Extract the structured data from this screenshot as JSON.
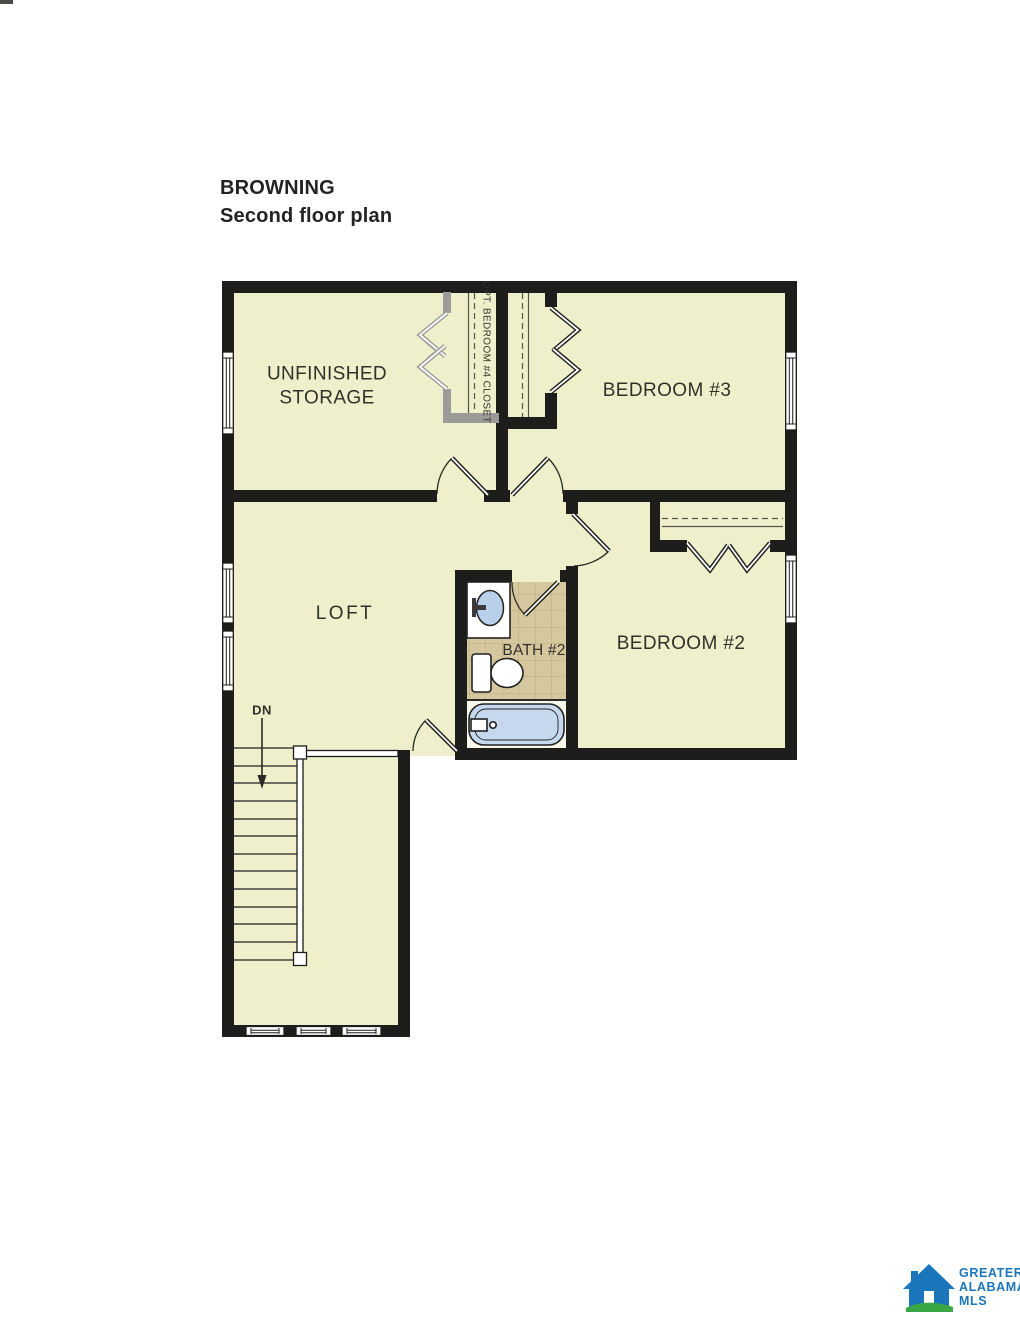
{
  "page": {
    "title_line1": "BROWNING",
    "title_line2": "Second floor plan"
  },
  "plan": {
    "rooms": [
      {
        "id": "unfinished-storage",
        "label": "UNFINISHED STORAGE"
      },
      {
        "id": "bedroom-3",
        "label": "BEDROOM #3"
      },
      {
        "id": "loft",
        "label": "LOFT"
      },
      {
        "id": "bath-2",
        "label": "BATH #2"
      },
      {
        "id": "bedroom-2",
        "label": "BEDROOM #2"
      }
    ],
    "annotations": {
      "optional_closet": "OPT. BEDROOM #4 CLOSET",
      "stairs_down": "DN"
    }
  },
  "logo": {
    "line1": "GREATER",
    "line2": "ALABAMA",
    "line3": "MLS"
  },
  "colors": {
    "floor": "#eff0cb",
    "wall": "#1d1d1b",
    "tile": "#d6c89e",
    "tub": "#c5d8ee",
    "sink": "#b9d0ea",
    "optional_gray": "#9a9a98",
    "logo_blue": "#1b75bb",
    "logo_green": "#3aa648",
    "label_text": "#31302b"
  }
}
